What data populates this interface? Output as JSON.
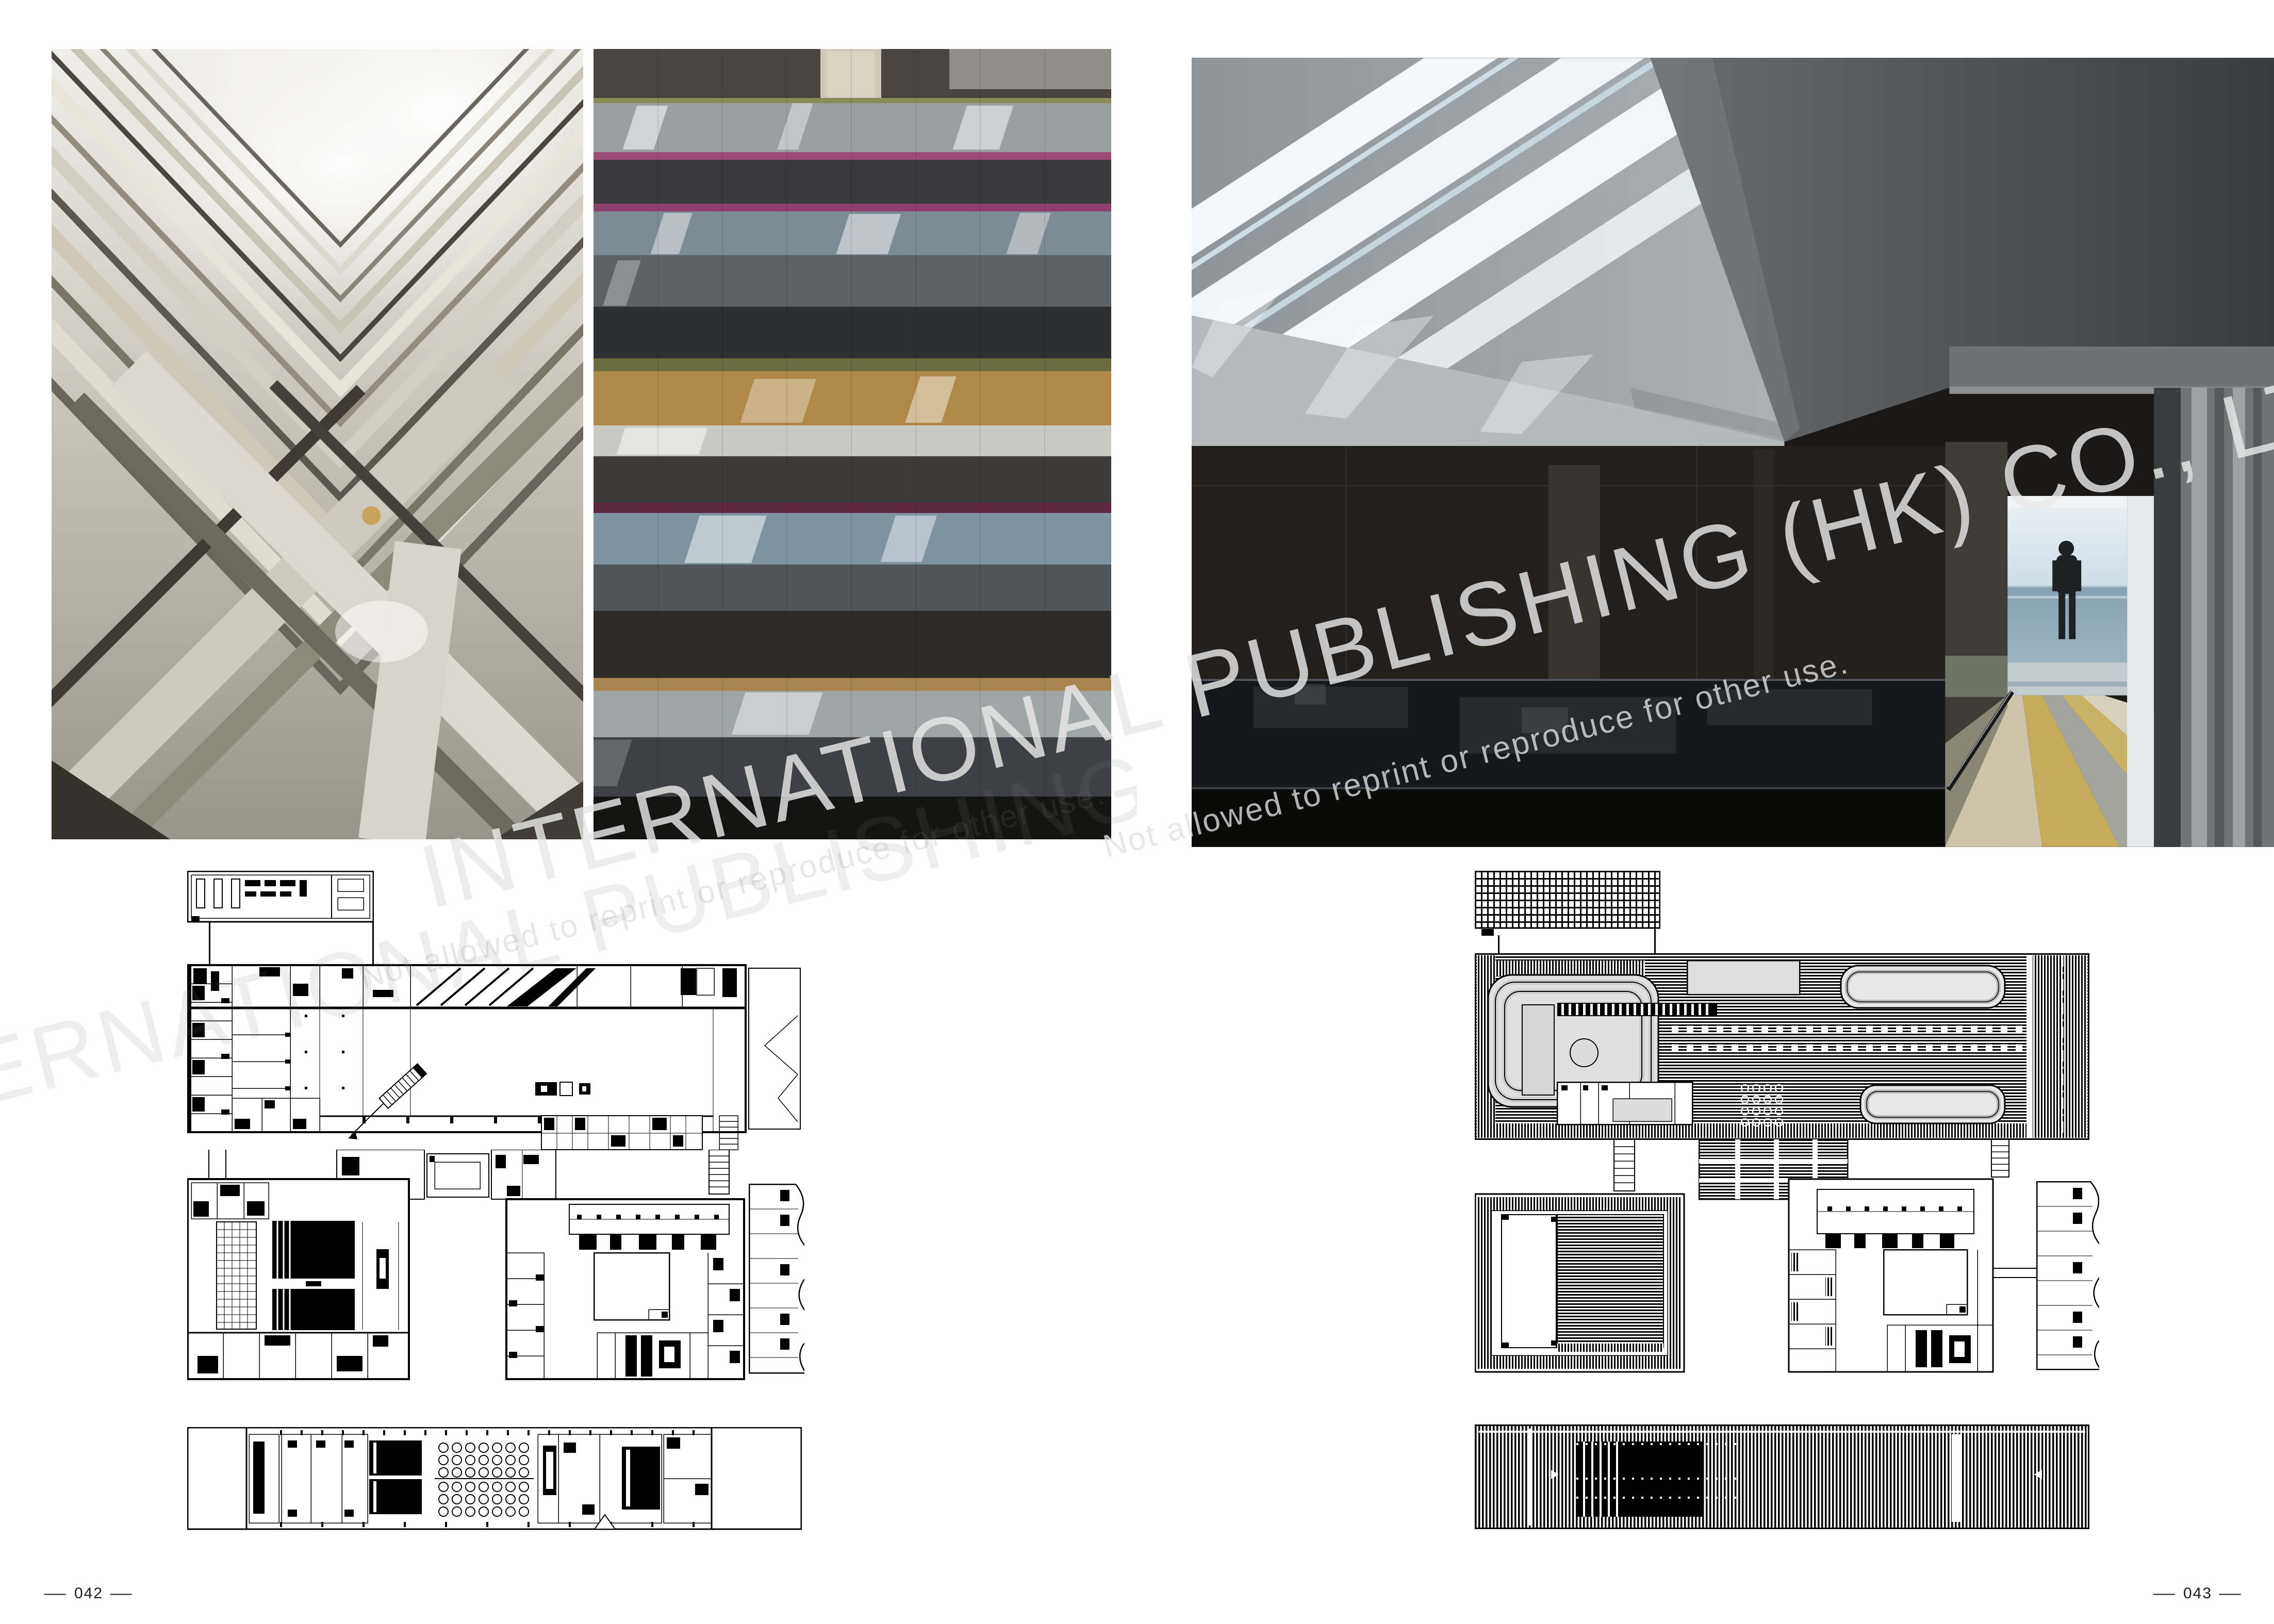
{
  "spread": {
    "left_page_number": "042",
    "right_page_number": "043",
    "dash": "—"
  },
  "watermark": {
    "company_line": "INTERNATIONAL PUBLISHING (HK) CO., LTD.",
    "notice_line": "Not allowed to reprint or reproduce for other use.",
    "rotation_deg": -14,
    "text_color": "#e8e8e8"
  },
  "figures": {
    "photo_atrium": "atrium-mirrored-chevron-lightwell",
    "photo_facade": "striped-mirror-and-stone-facade",
    "photo_corridor": "skylit-concrete-corridor-with-figure",
    "plan_left_small": "detached-block-plan",
    "plan_left_main": "upper-level-floor-plan",
    "plan_left_mid": "auditorium-level-floor-plan",
    "plan_left_strip": "long-bar-floor-plan",
    "plan_right_small": "trellis-roof-plan",
    "plan_right_main": "main-roof-plan",
    "plan_right_mid": "lower-roof-plan",
    "plan_right_strip": "long-bar-roof-plan"
  },
  "colors": {
    "paper": "#ffffff",
    "ink": "#000000",
    "plan_gray": "#d9d9d9",
    "facade_magenta": "#8f3f6e",
    "facade_tan": "#b08948",
    "floor_yellow": "#c4ac5c",
    "sea_blue": "#87a2b2"
  }
}
